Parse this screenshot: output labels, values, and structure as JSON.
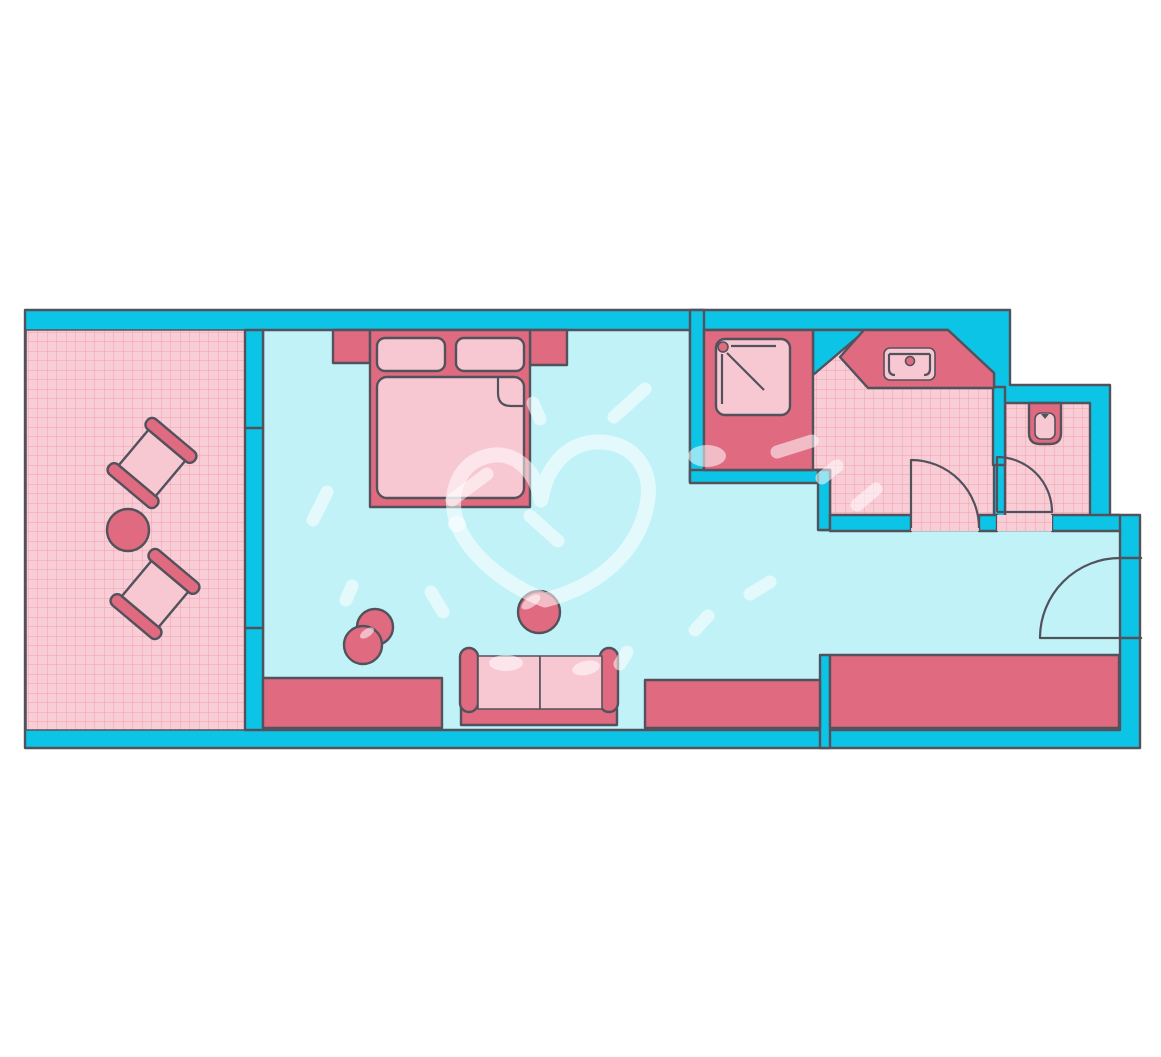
{
  "scene": {
    "type": "floor-plan-illustration",
    "subject": "hotel room floor plan, top-down view, no text labels",
    "rooms": [
      {
        "name": "balcony",
        "floor": "pink-grid",
        "contents": [
          "balcony-chair-1",
          "balcony-chair-2",
          "balcony-table"
        ]
      },
      {
        "name": "bedroom-living-area",
        "floor": "light-cyan",
        "contents": [
          "double-bed",
          "nightstand-left",
          "nightstand-right",
          "armchair",
          "side-table",
          "sofa",
          "sideboard-1",
          "sideboard-2",
          "wardrobe",
          "heart-doodle"
        ]
      },
      {
        "name": "bathroom",
        "floor": "pink-grid",
        "contents": [
          "shower",
          "sink-counter",
          "sink",
          "bathroom-door"
        ]
      },
      {
        "name": "wc",
        "floor": "pink-grid",
        "contents": [
          "toilet",
          "wc-door"
        ]
      }
    ],
    "doors": [
      "bathroom-door-swing",
      "wc-door-swing",
      "entry-door-swing"
    ],
    "decorations": [
      "white-heart-doodle",
      "white-paint-dabs"
    ]
  },
  "colors": {
    "background": "#ffffff",
    "wall": "#0cc4e6",
    "floor": "#c0f2f8",
    "floor_pink": "#f9cdd6",
    "grid_line": "#efa0b0",
    "furniture_dark": "#e06a80",
    "furniture_light": "#f8c8d2",
    "outline": "#52525c",
    "doodle": "rgba(255,255,255,0.55)"
  }
}
